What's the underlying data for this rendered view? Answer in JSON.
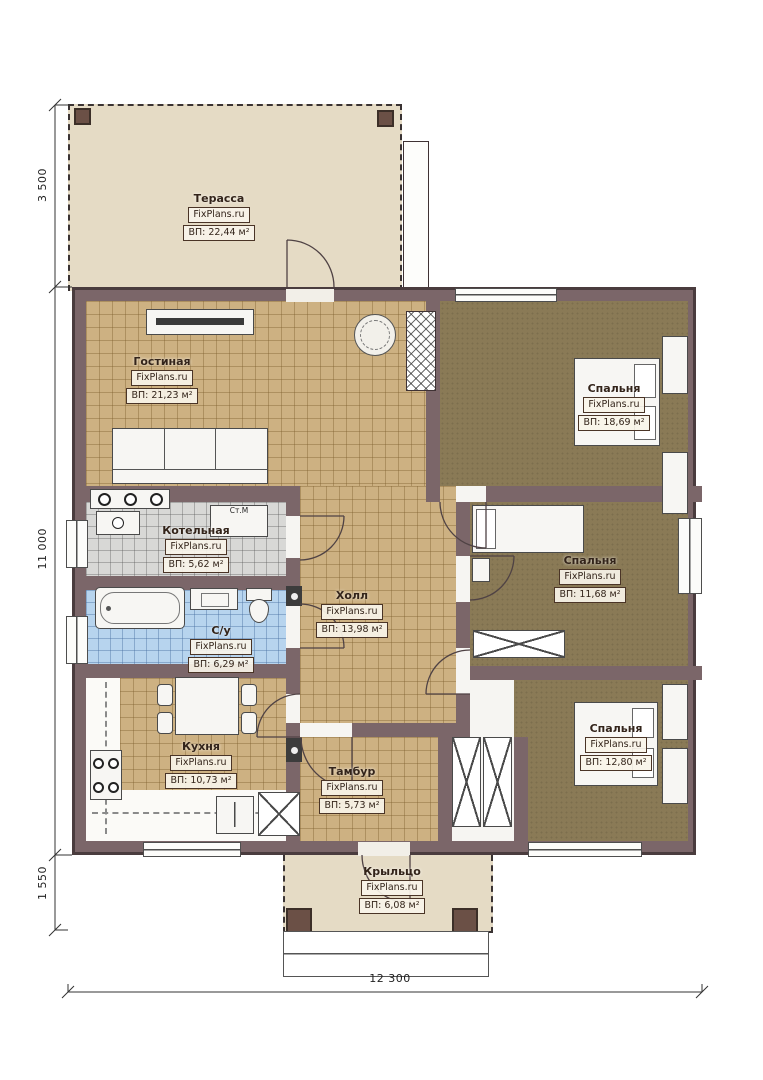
{
  "site_brand": "FixPlans.ru",
  "rooms": [
    {
      "id": "terrace",
      "name": "Терасса",
      "brand": "FixPlans.ru",
      "area": "ВП: 22,44 м²"
    },
    {
      "id": "living",
      "name": "Гостиная",
      "brand": "FixPlans.ru",
      "area": "ВП: 21,23 м²"
    },
    {
      "id": "bedroom1",
      "name": "Спальня",
      "brand": "FixPlans.ru",
      "area": "ВП: 18,69 м²"
    },
    {
      "id": "boiler",
      "name": "Котельная",
      "brand": "FixPlans.ru",
      "area": "ВП: 5,62 м²"
    },
    {
      "id": "hall",
      "name": "Холл",
      "brand": "FixPlans.ru",
      "area": "ВП: 13,98 м²"
    },
    {
      "id": "bedroom2",
      "name": "Спальня",
      "brand": "FixPlans.ru",
      "area": "ВП: 11,68 м²"
    },
    {
      "id": "bath",
      "name": "С/у",
      "brand": "FixPlans.ru",
      "area": "ВП: 6,29 м²"
    },
    {
      "id": "kitchen",
      "name": "Кухня",
      "brand": "FixPlans.ru",
      "area": "ВП: 10,73 м²"
    },
    {
      "id": "bedroom3",
      "name": "Спальня",
      "brand": "FixPlans.ru",
      "area": "ВП: 12,80 м²"
    },
    {
      "id": "tambur",
      "name": "Тамбур",
      "brand": "FixPlans.ru",
      "area": "ВП: 5,73 м²"
    },
    {
      "id": "porch",
      "name": "Крыльцо",
      "brand": "FixPlans.ru",
      "area": "ВП: 6,08 м²"
    }
  ],
  "dimensions": {
    "left_top": "3 500",
    "left_main": "11 000",
    "left_bottom": "1 550",
    "bottom": "12 300"
  },
  "annotations": {
    "washing_machine": "Ст.М"
  },
  "colors": {
    "wall": "#7b6669",
    "floor_tan": "#cdb182",
    "floor_bedroom": "#8a7a56",
    "floor_bath": "#b7d4ee",
    "floor_boiler": "#d8d8d6",
    "terrace": "#e5dbc5"
  }
}
